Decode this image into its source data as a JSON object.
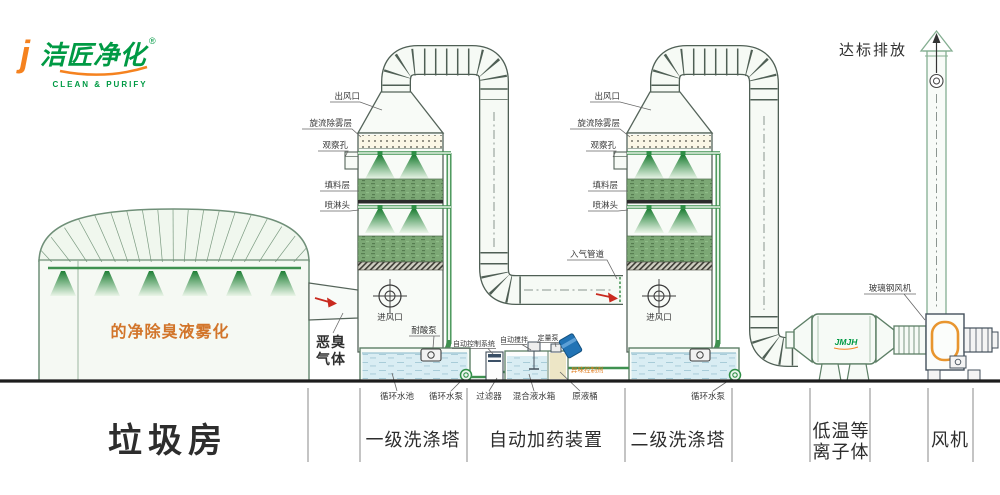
{
  "colors": {
    "brand_green": "#009a44",
    "brand_orange": "#f5821f",
    "spray_orange": "#d2752a",
    "agent_orange": "#e07c1e",
    "pipe_green": "#3f9150",
    "packing_green": "#7ca875",
    "water_blue": "#d9edf3",
    "arrow_red": "#c92a1f"
  },
  "logo": {
    "j": "j",
    "brand": "洁匠净化",
    "reg": "®",
    "tagline": "CLEAN & PURIFY"
  },
  "stack": {
    "emission": "达标排放"
  },
  "room": {
    "spray_text": "的净除臭液雾化",
    "gas1": "恶臭",
    "gas2": "气体"
  },
  "tower1": {
    "outlet": "出风口",
    "demister": "旋流除雾层",
    "viewport": "观察孔",
    "packing": "填料层",
    "spray_head": "喷淋头",
    "inlet": "进风口",
    "pump": "耐酸泵"
  },
  "tower2": {
    "outlet": "出风口",
    "demister": "旋流除雾层",
    "viewport": "观察孔",
    "packing": "填料层",
    "spray_head": "喷淋头",
    "inlet": "进风口",
    "inlet_duct": "入气管道"
  },
  "dosing": {
    "control": "自动控制系统",
    "stirrer": "自动搅拌",
    "pump": "定量泵",
    "agent": "异味控制剂"
  },
  "ground": {
    "pool1": "循环水池",
    "pump1": "循环水泵",
    "filter": "过滤器",
    "tank": "混合液水箱",
    "barrel": "原液桶",
    "pump2": "循环水泵"
  },
  "right": {
    "fan": "玻璃钢风机",
    "tank_logo": "JMJH"
  },
  "sections": {
    "room": "垃圾房",
    "tower1": "一级洗涤塔",
    "dosing": "自动加药装置",
    "tower2": "二级洗涤塔",
    "plasma1": "低温等",
    "plasma2": "离子体",
    "fan": "风机"
  }
}
